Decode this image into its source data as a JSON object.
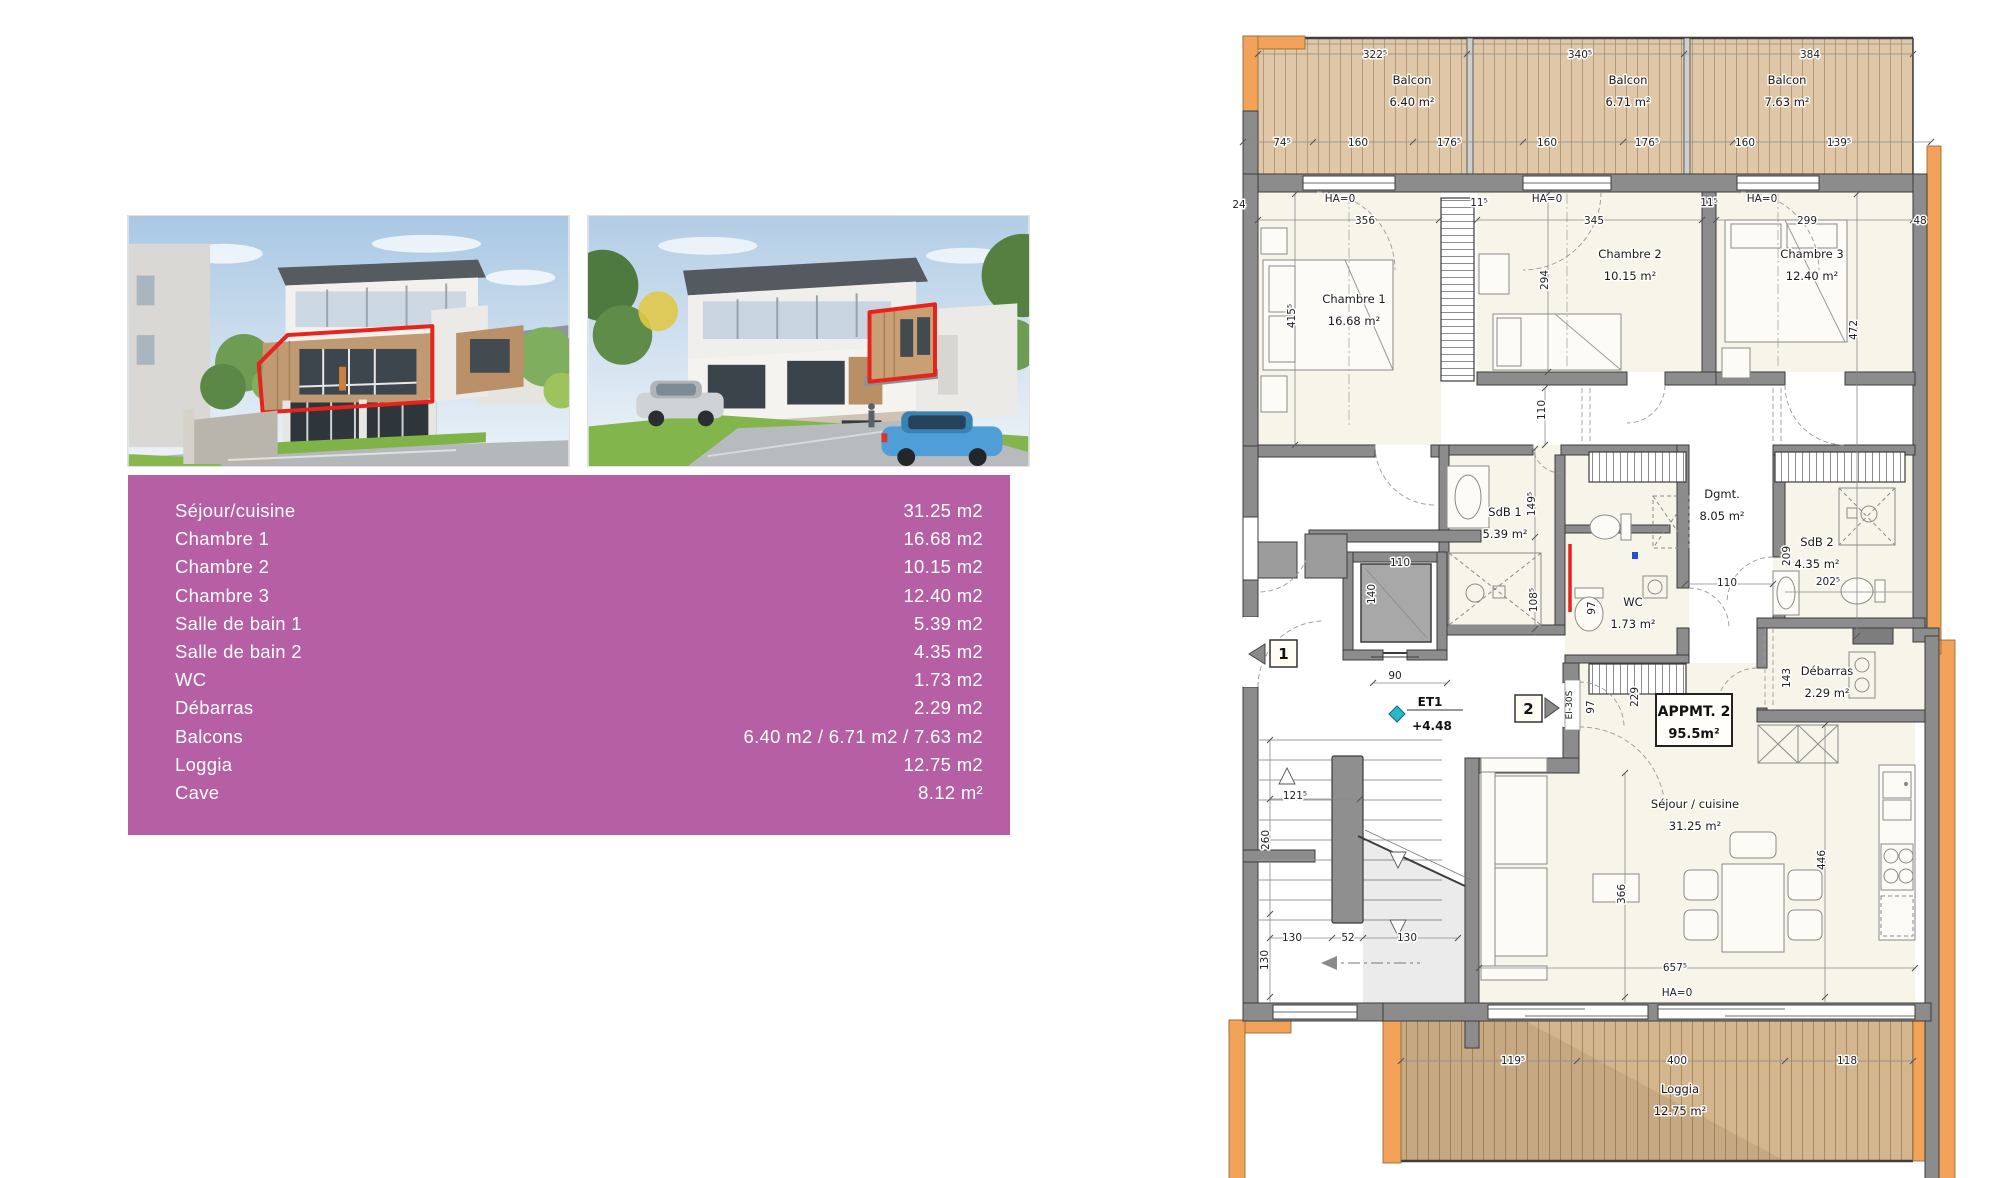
{
  "colors": {
    "table_bg": "#b65fa5",
    "table_text": "#ffffff",
    "highlight_outline": "#e8221c",
    "wall_gray": "#8c8c8c",
    "wall_orange": "#f2a359",
    "deck_wood": "#dfc7a8",
    "room_fill": "#f7f5ea",
    "level_marker_teal": "#29b6c8",
    "annotation_red": "#e8221c",
    "annotation_blue": "#2450d8"
  },
  "table": {
    "rows": [
      {
        "label": "Séjour/cuisine",
        "value": "31.25 m2"
      },
      {
        "label": "Chambre 1",
        "value": "16.68 m2"
      },
      {
        "label": "Chambre 2",
        "value": "10.15 m2"
      },
      {
        "label": "Chambre 3",
        "value": "12.40 m2"
      },
      {
        "label": "Salle de bain 1",
        "value": "5.39 m2"
      },
      {
        "label": "Salle de bain 2",
        "value": "4.35 m2"
      },
      {
        "label": "WC",
        "value": "1.73 m2"
      },
      {
        "label": "Débarras",
        "value": "2.29 m2"
      },
      {
        "label": "Balcons",
        "value": "6.40 m2 / 6.71 m2 / 7.63 m2"
      },
      {
        "label": "Loggia",
        "value": "12.75 m2"
      },
      {
        "label": "Cave",
        "value": "8.12 m²"
      }
    ]
  },
  "floorplan": {
    "apartment_box": {
      "title": "APPMT. 2",
      "area": "95.5m²"
    },
    "level_marker": {
      "label": "ET1",
      "value": "+4.48"
    },
    "markers": {
      "left": "1",
      "right": "2",
      "door": "EI-30S"
    },
    "rooms": [
      {
        "name": "Balcon",
        "area": "6.40 m²",
        "x": 187,
        "y": 76
      },
      {
        "name": "Balcon",
        "area": "6.71 m²",
        "x": 403,
        "y": 76
      },
      {
        "name": "Balcon",
        "area": "7.63 m²",
        "x": 562,
        "y": 76
      },
      {
        "name": "Chambre 1",
        "area": "16.68 m²",
        "x": 129,
        "y": 295
      },
      {
        "name": "Chambre 2",
        "area": "10.15 m²",
        "x": 405,
        "y": 250
      },
      {
        "name": "Chambre 3",
        "area": "12.40 m²",
        "x": 587,
        "y": 250
      },
      {
        "name": "SdB 1",
        "area": "5.39 m²",
        "x": 280,
        "y": 508
      },
      {
        "name": "WC",
        "area": "1.73 m²",
        "x": 408,
        "y": 598
      },
      {
        "name": "Dgmt.",
        "area": "8.05 m²",
        "x": 497,
        "y": 490
      },
      {
        "name": "SdB 2",
        "area": "4.35 m²",
        "x": 592,
        "y": 538
      },
      {
        "name": "Débarras",
        "area": "2.29 m²",
        "x": 602,
        "y": 667
      },
      {
        "name": "Séjour / cuisine",
        "area": "31.25 m²",
        "x": 470,
        "y": 800
      },
      {
        "name": "Loggia",
        "area": "12.75 m²",
        "x": 455,
        "y": 1085
      }
    ],
    "dims": [
      {
        "t": "322⁵",
        "x": 150,
        "y": 50
      },
      {
        "t": "340⁵",
        "x": 355,
        "y": 50
      },
      {
        "t": "384",
        "x": 585,
        "y": 50
      },
      {
        "t": "74⁵",
        "x": 57,
        "y": 138
      },
      {
        "t": "160",
        "x": 133,
        "y": 138
      },
      {
        "t": "176⁵",
        "x": 224,
        "y": 138
      },
      {
        "t": "160",
        "x": 322,
        "y": 138
      },
      {
        "t": "176⁵",
        "x": 422,
        "y": 138
      },
      {
        "t": "160",
        "x": 520,
        "y": 138
      },
      {
        "t": "139⁵",
        "x": 614,
        "y": 138
      },
      {
        "t": "24",
        "x": 14,
        "y": 200
      },
      {
        "t": "356",
        "x": 140,
        "y": 216
      },
      {
        "t": "11⁵",
        "x": 254,
        "y": 198
      },
      {
        "t": "345",
        "x": 369,
        "y": 216
      },
      {
        "t": "11⁵",
        "x": 484,
        "y": 198
      },
      {
        "t": "299",
        "x": 582,
        "y": 216
      },
      {
        "t": "48",
        "x": 695,
        "y": 216
      },
      {
        "t": "HA=0",
        "x": 115,
        "y": 194
      },
      {
        "t": "HA=0",
        "x": 322,
        "y": 194
      },
      {
        "t": "HA=0",
        "x": 537,
        "y": 194
      },
      {
        "t": "415⁵",
        "x": 70,
        "y": 308,
        "r": -90
      },
      {
        "t": "294",
        "x": 323,
        "y": 272,
        "r": -90
      },
      {
        "t": "472",
        "x": 632,
        "y": 322,
        "r": -90
      },
      {
        "t": "110",
        "x": 320,
        "y": 402,
        "r": -90
      },
      {
        "t": "149⁵",
        "x": 310,
        "y": 496,
        "r": -90
      },
      {
        "t": "108⁵",
        "x": 312,
        "y": 592,
        "r": -90
      },
      {
        "t": "97",
        "x": 370,
        "y": 600,
        "r": -90
      },
      {
        "t": "110",
        "x": 502,
        "y": 578
      },
      {
        "t": "209",
        "x": 565,
        "y": 548,
        "r": -90
      },
      {
        "t": "202⁵",
        "x": 603,
        "y": 577
      },
      {
        "t": "143",
        "x": 565,
        "y": 670,
        "r": -90
      },
      {
        "t": "110",
        "x": 175,
        "y": 558
      },
      {
        "t": "140",
        "x": 150,
        "y": 586,
        "r": -90
      },
      {
        "t": "90",
        "x": 170,
        "y": 671
      },
      {
        "t": "97",
        "x": 369,
        "y": 699,
        "r": -90
      },
      {
        "t": "229",
        "x": 413,
        "y": 689,
        "r": -90
      },
      {
        "t": "121⁵",
        "x": 70,
        "y": 791
      },
      {
        "t": "260",
        "x": 44,
        "y": 832,
        "r": -90
      },
      {
        "t": "130",
        "x": 67,
        "y": 933
      },
      {
        "t": "52",
        "x": 123,
        "y": 933
      },
      {
        "t": "130",
        "x": 182,
        "y": 933
      },
      {
        "t": "130",
        "x": 43,
        "y": 952,
        "r": -90
      },
      {
        "t": "366",
        "x": 400,
        "y": 886,
        "r": -90
      },
      {
        "t": "446",
        "x": 600,
        "y": 852,
        "r": -90
      },
      {
        "t": "657⁵",
        "x": 450,
        "y": 963
      },
      {
        "t": "HA=0",
        "x": 452,
        "y": 988
      },
      {
        "t": "119⁵",
        "x": 288,
        "y": 1056
      },
      {
        "t": "400",
        "x": 452,
        "y": 1056
      },
      {
        "t": "118",
        "x": 622,
        "y": 1056
      }
    ]
  }
}
